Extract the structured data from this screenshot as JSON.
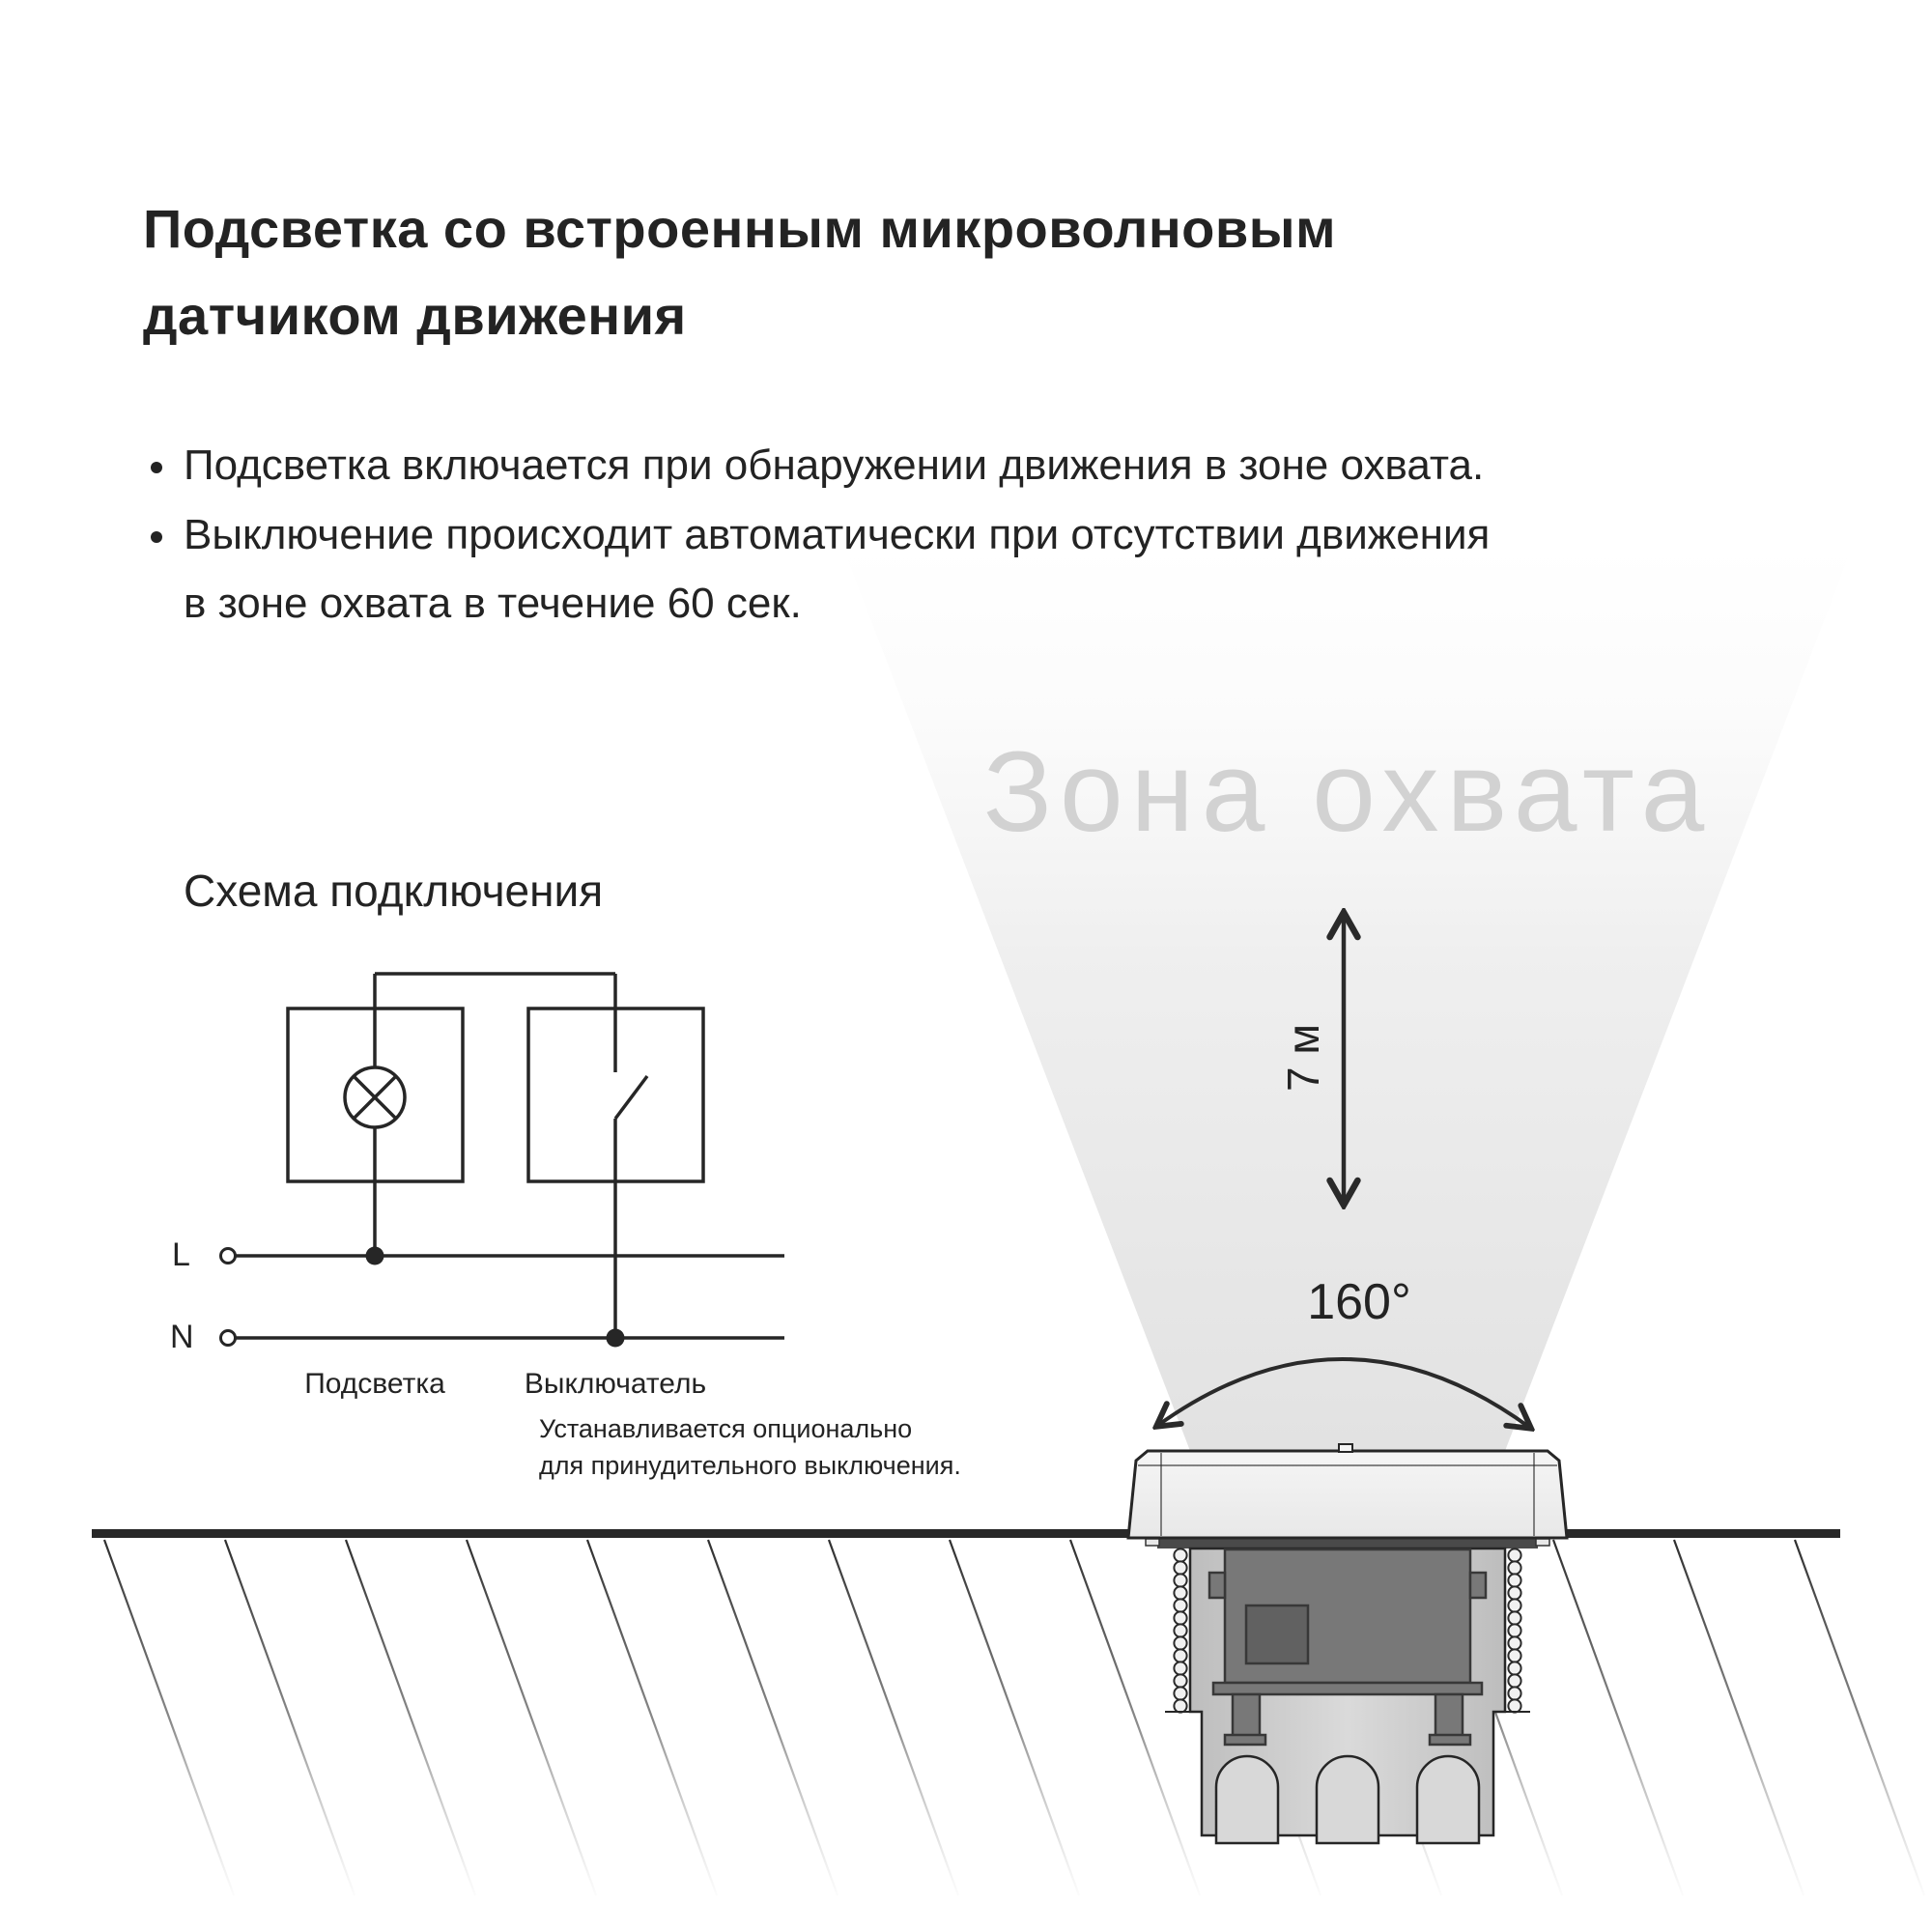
{
  "colors": {
    "text": "#232323",
    "line": "#262626",
    "watermark_gray": "#d2d2d2",
    "cone_light": "#f2f2f2",
    "cone_dark": "#e2e2e2"
  },
  "header": {
    "title_lines": [
      "Подсветка со встроенным микроволновым",
      "датчиком движения"
    ]
  },
  "bullets": [
    {
      "lines": [
        "Подсветка включается при обнаружении движения в зоне охвата."
      ]
    },
    {
      "lines": [
        "Выключение происходит автоматически при отсутствии движения",
        "в зоне охвата в течение 60 сек."
      ]
    }
  ],
  "wiring": {
    "heading": "Схема подключения",
    "terminal_l": "L",
    "terminal_n": "N",
    "lamp_label": "Подсветка",
    "switch_label": "Выключатель",
    "note_lines": [
      "Устанавливается опционально",
      "для принудительного выключения."
    ]
  },
  "coverage": {
    "watermark": "Зона охвата",
    "range_label": "7 м",
    "angle_label": "160°"
  }
}
